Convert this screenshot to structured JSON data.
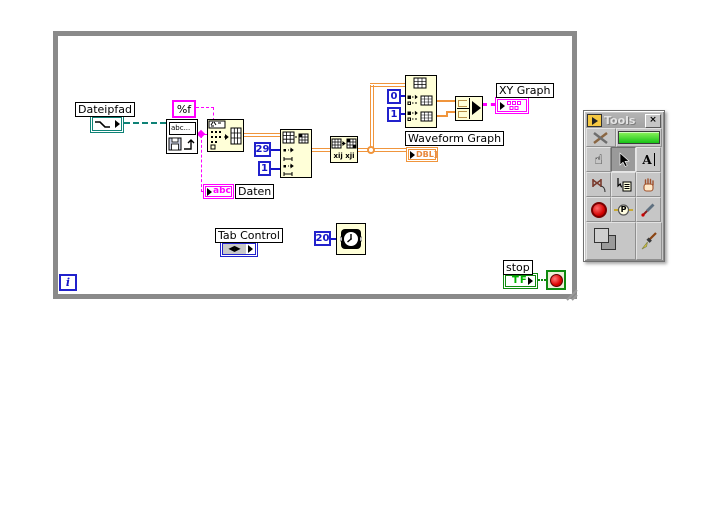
{
  "diagram": {
    "labels": {
      "dateipfad": "Dateipfad",
      "daten": "Daten",
      "tab_control": "Tab Control",
      "waveform_graph": "Waveform Graph",
      "xy_graph": "XY Graph",
      "stop": "stop"
    },
    "constants": {
      "format_string": "%f",
      "subset_index": "29",
      "subset_length": "1",
      "index_0": "0",
      "index_1": "1",
      "wait_ms": "20"
    },
    "glyphs": {
      "read_vi": "abc...",
      "daten_term": "abc",
      "dbl_term": "DBL]",
      "tf_term": "TF",
      "iteration": "i",
      "tab_term": "◀▶",
      "transpose": "xij xji"
    }
  },
  "tools_palette": {
    "title": "Tools",
    "close_label": "×",
    "edit_text_glyph": "A",
    "probe_glyph": "P",
    "tools": [
      "automatic-tool-selection",
      "auto-select-led",
      "operate-value",
      "position-select",
      "edit-text",
      "connect-wire",
      "object-shortcut-menu",
      "scroll-window",
      "set-breakpoint",
      "probe-data",
      "get-color",
      "set-color",
      "paintbrush"
    ]
  },
  "colors": {
    "loop_border": "#8A8A8A",
    "node_fill": "#FFFFD8",
    "string_pink": "#FF00FF",
    "numeric_blue": "#1515C8",
    "float_orange": "#F0953C",
    "path_teal": "#0E8276",
    "boolean_green": "#0E8A0E",
    "stop_red": "#DD0000",
    "led_green": "#33E433",
    "palette_gray": "#C6C6C6"
  }
}
